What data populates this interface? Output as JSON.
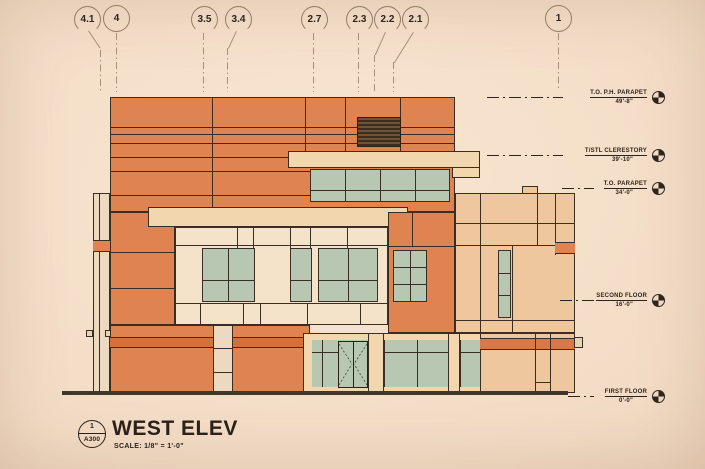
{
  "drawing": {
    "title": "WEST ELEV",
    "scale": "SCALE:  1/8\" = 1'-0\"",
    "detail_number": "1",
    "sheet_number": "A300",
    "grid_markers": [
      {
        "label": "4.1"
      },
      {
        "label": "4"
      },
      {
        "label": "3.5"
      },
      {
        "label": "3.4"
      },
      {
        "label": "2.7"
      },
      {
        "label": "2.3"
      },
      {
        "label": "2.2"
      },
      {
        "label": "2.1"
      },
      {
        "label": "1"
      }
    ],
    "levels": [
      {
        "name": "T.O. P.H. PARAPET",
        "elevation": "49'-8\""
      },
      {
        "name": "T/STL CLERESTORY",
        "elevation": "39'-10\""
      },
      {
        "name": "T.O. PARAPET",
        "elevation": "34'-0\""
      },
      {
        "name": "SECOND FLOOR",
        "elevation": "16'-0\""
      },
      {
        "name": "FIRST FLOOR",
        "elevation": "0'-0\""
      }
    ],
    "colors": {
      "background": "#f3ddc8",
      "wall_orange": "#df8351",
      "band_orange": "#d2703e",
      "wall_tan": "#eec79e",
      "trim_cream": "#f2d6ae",
      "panel_cream": "#f5e3c9",
      "glass_green": "#b7c7b2",
      "louver_brown": "#54402e",
      "line": "#3a2e24"
    }
  }
}
